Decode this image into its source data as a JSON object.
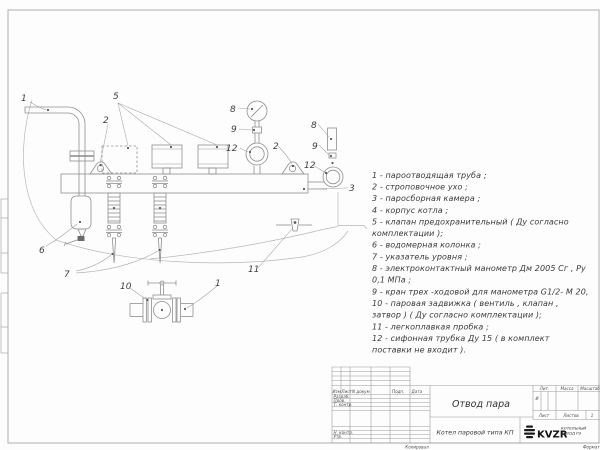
{
  "drawing": {
    "title": "Отвод пара",
    "callouts": [
      {
        "label": "1"
      },
      {
        "label": "5"
      },
      {
        "label": "2"
      },
      {
        "label": "8"
      },
      {
        "label": "9"
      },
      {
        "label": "12"
      },
      {
        "label": "2"
      },
      {
        "label": "8"
      },
      {
        "label": "9"
      },
      {
        "label": "12"
      },
      {
        "label": "3"
      },
      {
        "label": "6"
      },
      {
        "label": "7"
      },
      {
        "label": "10"
      },
      {
        "label": "1"
      },
      {
        "label": "11"
      }
    ]
  },
  "parts_list": {
    "lines": [
      "1 -  пароотводящая труба ;",
      "2 -  строповочное ухо ;",
      "3 -  паросборная камера ;",
      "4 -  корпус котла ;",
      "5 -  клапан предохранительный  ( Ду согласно",
      "комплектации );",
      "6 -  водомерная колонка ;",
      "7 - указатель уровня ;",
      "8 - электроконтактный манометр  Дм 2005 Сг ,  Ру",
      "0,1  МПа ;",
      "9 -  кран трех -ходовой для манометра  G1/2- М 20,",
      "10 -  паровая задвижка   ( вентиль ,  клапан ,",
      "затвор ) ( Ду согласно комплектации );",
      "11 -  легкоплавкая пробка ;",
      "12 -  сифонная трубка  Ду 15 ( в комплект",
      "поставки не входит )."
    ]
  },
  "title_block": {
    "doc_title": "Отвод пара",
    "subtitle": "Котел паровой типа КП",
    "logo_text": "KVZR",
    "company_line1": "КОТЕЛЬНЫЙ",
    "company_line2": "ЗАВОД РЭ",
    "col_izm": "Изм",
    "col_list": "Лист",
    "col_ndokum": "N докум",
    "col_podp": "Подп.",
    "col_data": "Дата",
    "row_razrab": "Разраб.",
    "row_prov": "Пров.",
    "row_tkontr": "Т. контр.",
    "row_nkontr": "Н. контр.",
    "row_utv": "Утв.",
    "lit_header": "Лит.",
    "massa_header": "Масса",
    "masshtab_header": "Масштаб",
    "lit_value": "И",
    "sheet_label": "Лист",
    "sheets_label": "Листов",
    "sheets_value": "1",
    "footer_copy": "Копировал",
    "footer_format": "Формат А4"
  }
}
